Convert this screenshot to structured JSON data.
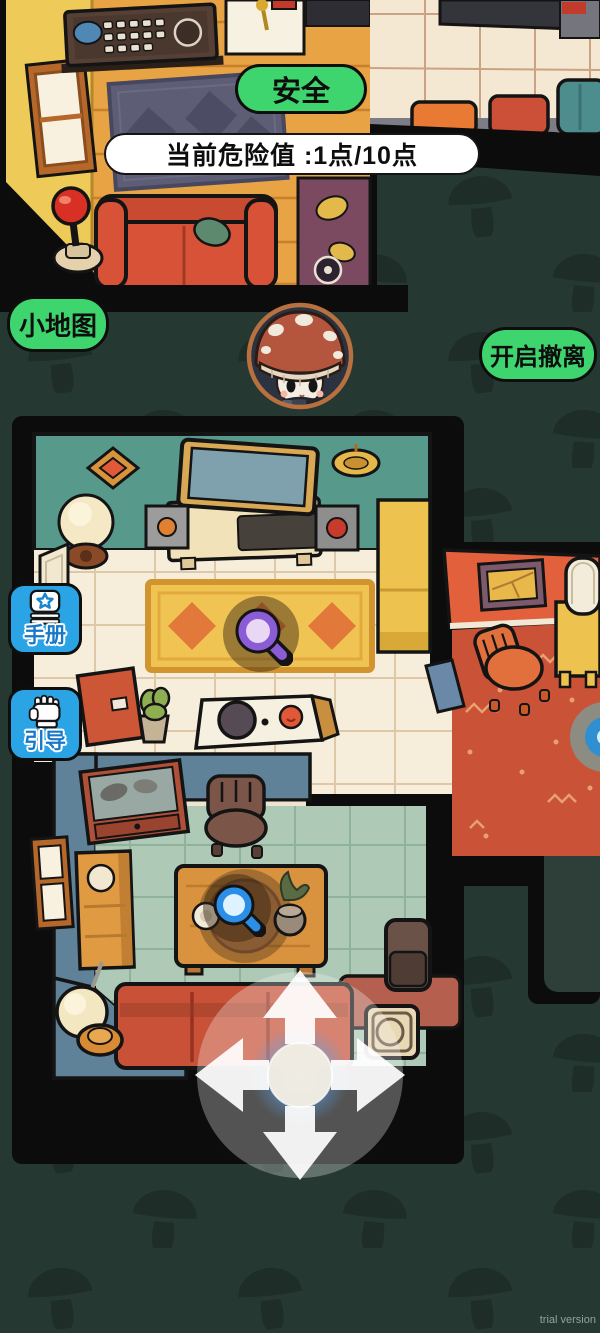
{
  "hud": {
    "safety_badge": {
      "label": "安全"
    },
    "danger_meter": {
      "label": "当前危险值 :1点/10点"
    },
    "minimap_button": {
      "label": "小地图"
    },
    "evacuate_button": {
      "label": "开启撤离"
    },
    "manual_button": {
      "label": "手册"
    },
    "guide_button": {
      "label": "引导"
    },
    "trial_label": "trial version"
  },
  "colors": {
    "background": "#253832",
    "pattern": "#1f2d28",
    "button_green": "#3ed56e",
    "button_blue": "#2aa4e4",
    "button_blue_text": "#1878c8",
    "danger_pill_bg": "#ffffff",
    "magnifier_purple": "#8b5cd6",
    "magnifier_blue": "#2b8fe8"
  }
}
